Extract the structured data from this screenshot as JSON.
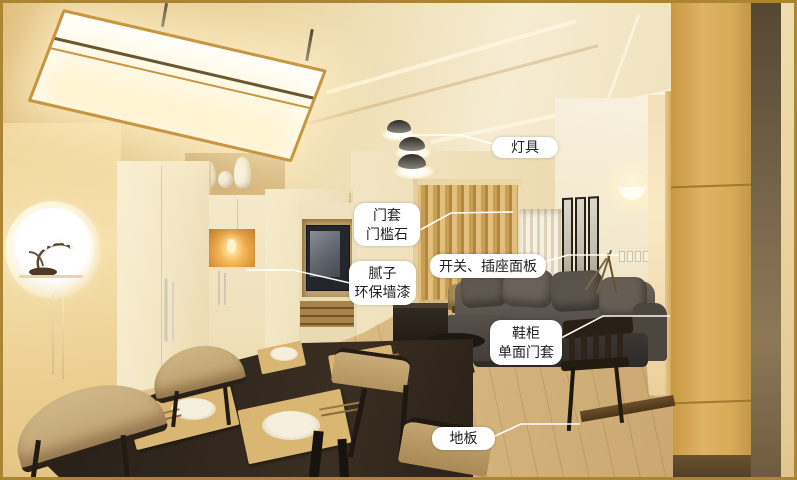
{
  "annotations": [
    {
      "id": "lighting",
      "text": "灯具"
    },
    {
      "id": "door-frame",
      "text": "门套\n门槛石"
    },
    {
      "id": "switch-socket",
      "text": "开关、插座面板"
    },
    {
      "id": "putty-paint",
      "text": "腻子\n环保墙漆"
    },
    {
      "id": "shoe-cabinet",
      "text": "鞋柜\n单面门套"
    },
    {
      "id": "floor",
      "text": "地板"
    }
  ],
  "colors": {
    "frame_gold": "#ab8531",
    "label_bg": "#ffffff",
    "label_text": "#202020",
    "leader_line": "#ffffff",
    "ceiling_warm": "#ecd6a4",
    "wall_cream": "#f2e6c8",
    "curtain_gold": "#c99e55",
    "cabinet_gold": "#d8ab58",
    "sofa_gray": "#57504a",
    "table_wood_dark": "#2a211a",
    "floor_wood": "#d9ba83",
    "lamp_glow": "#fff6dd"
  }
}
